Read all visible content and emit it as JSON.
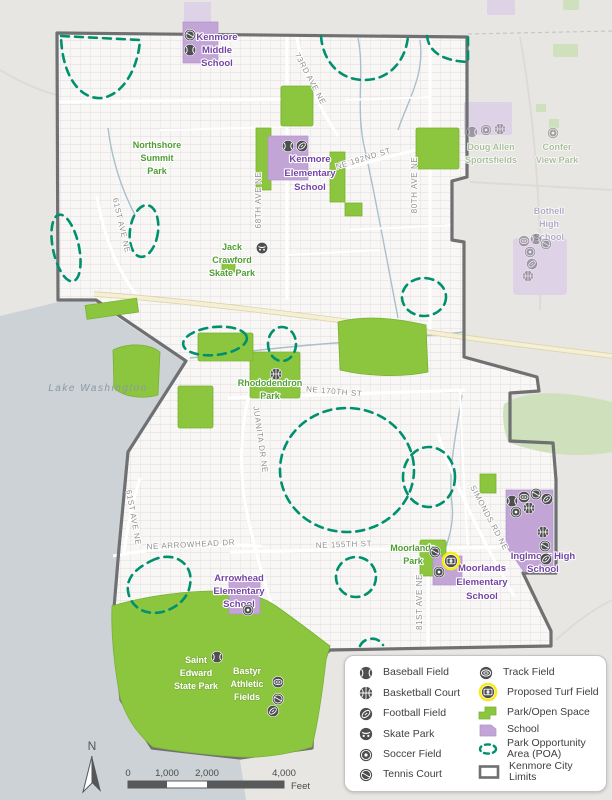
{
  "labels": {
    "lake": "Lake Washington",
    "northshore": [
      "Northshore",
      "Summit",
      "Park"
    ],
    "kenmore_middle": [
      "Kenmore",
      "Middle",
      "School"
    ],
    "kenmore_elementary": [
      "Kenmore",
      "Elementary",
      "School"
    ],
    "jack_crawford": [
      "Jack",
      "Crawford",
      "Skate Park"
    ],
    "rhododendron": [
      "Rhododendron",
      "Park"
    ],
    "moorlands_park": [
      "Moorlands",
      "Park"
    ],
    "moorlands_elementary": [
      "Moorlands",
      "Elementary",
      "School"
    ],
    "inglmoor": [
      "Inglmoor High",
      "School"
    ],
    "arrowhead": [
      "Arrowhead",
      "Elementary",
      "School"
    ],
    "saint_edward": [
      "Saint",
      "Edward",
      "State Park"
    ],
    "bastyr": [
      "Bastyr",
      "Athletic",
      "Fields"
    ],
    "doug_allen": [
      "Doug Allen",
      "Sportsfields"
    ],
    "confer_view": [
      "Confer",
      "View Park"
    ],
    "bothell_high": [
      "Bothell",
      "High",
      "School"
    ]
  },
  "streets": {
    "s73rd": "73RD AVE NE",
    "ne192nd": "NE 192ND ST",
    "s80th": "80TH AVE NE",
    "s68th": "68TH AVE NE",
    "s61st_n": "61ST AVE NE",
    "s61st_s": "61ST AVE NE",
    "juanita": "JUANITA DR NE",
    "ne170th": "NE 170TH ST",
    "ne_arrowhead": "NE ARROWHEAD DR",
    "ne155th": "NE 155TH ST",
    "simonds": "SIMONDS RD NE",
    "s81st": "81ST AVE NE"
  },
  "legend": {
    "left": [
      {
        "icon": "baseball-icon",
        "label": "Baseball Field"
      },
      {
        "icon": "basketball-icon",
        "label": "Basketball Court"
      },
      {
        "icon": "football-icon",
        "label": "Football Field"
      },
      {
        "icon": "skate-icon",
        "label": "Skate Park"
      },
      {
        "icon": "soccer-icon",
        "label": "Soccer Field"
      },
      {
        "icon": "tennis-icon",
        "label": "Tennis Court"
      }
    ],
    "right": [
      {
        "icon": "track-icon",
        "label": "Track Field"
      },
      {
        "icon": "proposed-turf-icon",
        "label": "Proposed Turf Field"
      },
      {
        "icon": "park-swatch",
        "label": "Park/Open Space"
      },
      {
        "icon": "school-swatch",
        "label": "School"
      },
      {
        "icon": "poa-swatch",
        "lines": [
          "Park Opportunity",
          "Area (POA)"
        ]
      },
      {
        "icon": "city-limits-swatch",
        "label": "Kenmore City Limits"
      }
    ]
  },
  "scalebar": {
    "ticks": [
      "0",
      "1,000",
      "2,000",
      "4,000"
    ],
    "unit": "Feet"
  },
  "north_label": "N",
  "facility_icons": {
    "kenmore_middle": [
      "tennis",
      "baseball"
    ],
    "kenmore_elementary": [
      "baseball",
      "football"
    ],
    "jack_crawford": [
      "skate"
    ],
    "rhododendron": [
      "basketball"
    ],
    "arrowhead": [
      "soccer"
    ],
    "saint_edward": [
      "baseball"
    ],
    "bastyr": [
      "track",
      "tennis",
      "football"
    ],
    "moorlands": [
      "tennis",
      "proposed-turf",
      "soccer"
    ],
    "inglmoor": [
      "baseball",
      "track",
      "tennis",
      "football",
      "soccer",
      "basketball",
      "basketball",
      "tennis",
      "football"
    ],
    "bothell_high": [
      "track",
      "baseball",
      "tennis",
      "soccer",
      "football",
      "basketball"
    ],
    "doug_allen": [
      "baseball",
      "soccer",
      "basketball"
    ],
    "confer_view": [
      "soccer"
    ]
  },
  "colors": {
    "park_green": "#8cc63e",
    "school_purple": "#c3a4d7",
    "poa_teal": "#00906e",
    "city_limits_gray": "#6f7072",
    "proposed_turf_yellow": "#f7ec13",
    "water_gray": "#ccd2d6"
  }
}
